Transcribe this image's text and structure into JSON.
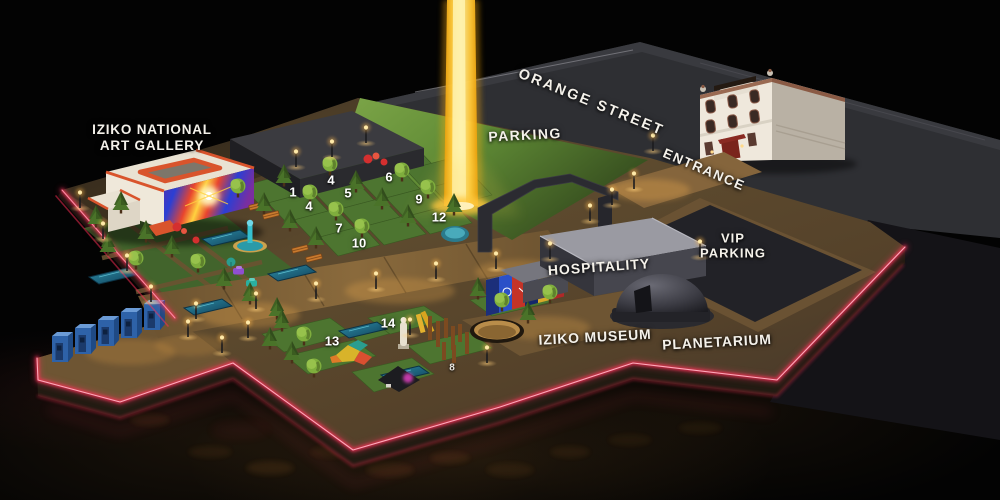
{
  "map": {
    "labels": {
      "gallery_line1": "IZIKO NATIONAL",
      "gallery_line2": "ART GALLERY",
      "orange_street": "ORANGE STREET",
      "parking": "PARKING",
      "entrance": "ENTRANCE",
      "vip_line1": "VIP",
      "vip_line2": "PARKING",
      "hospitality": "HOSPITALITY",
      "museum": "IZIKO MUSEUM",
      "planetarium": "PLANETARIUM"
    },
    "markers": [
      {
        "label": "1",
        "x": 293,
        "y": 192
      },
      {
        "label": "4",
        "x": 331,
        "y": 180
      },
      {
        "label": "4",
        "x": 309,
        "y": 206
      },
      {
        "label": "5",
        "x": 348,
        "y": 193
      },
      {
        "label": "6",
        "x": 389,
        "y": 177
      },
      {
        "label": "9",
        "x": 419,
        "y": 199
      },
      {
        "label": "12",
        "x": 439,
        "y": 217
      },
      {
        "label": "7",
        "x": 339,
        "y": 228
      },
      {
        "label": "10",
        "x": 359,
        "y": 243
      },
      {
        "label": "13",
        "x": 332,
        "y": 341
      },
      {
        "label": "14",
        "x": 388,
        "y": 323
      },
      {
        "label": "8",
        "x": 452,
        "y": 368,
        "dim": true
      }
    ],
    "colors": {
      "neon": "#ff2e56",
      "beam_core": "#ffeea0",
      "lawn": "#5f8a35",
      "pool": "#1f6a84",
      "toilet_blue": "#2e62a8",
      "roof_orange": "#d9542c"
    }
  }
}
